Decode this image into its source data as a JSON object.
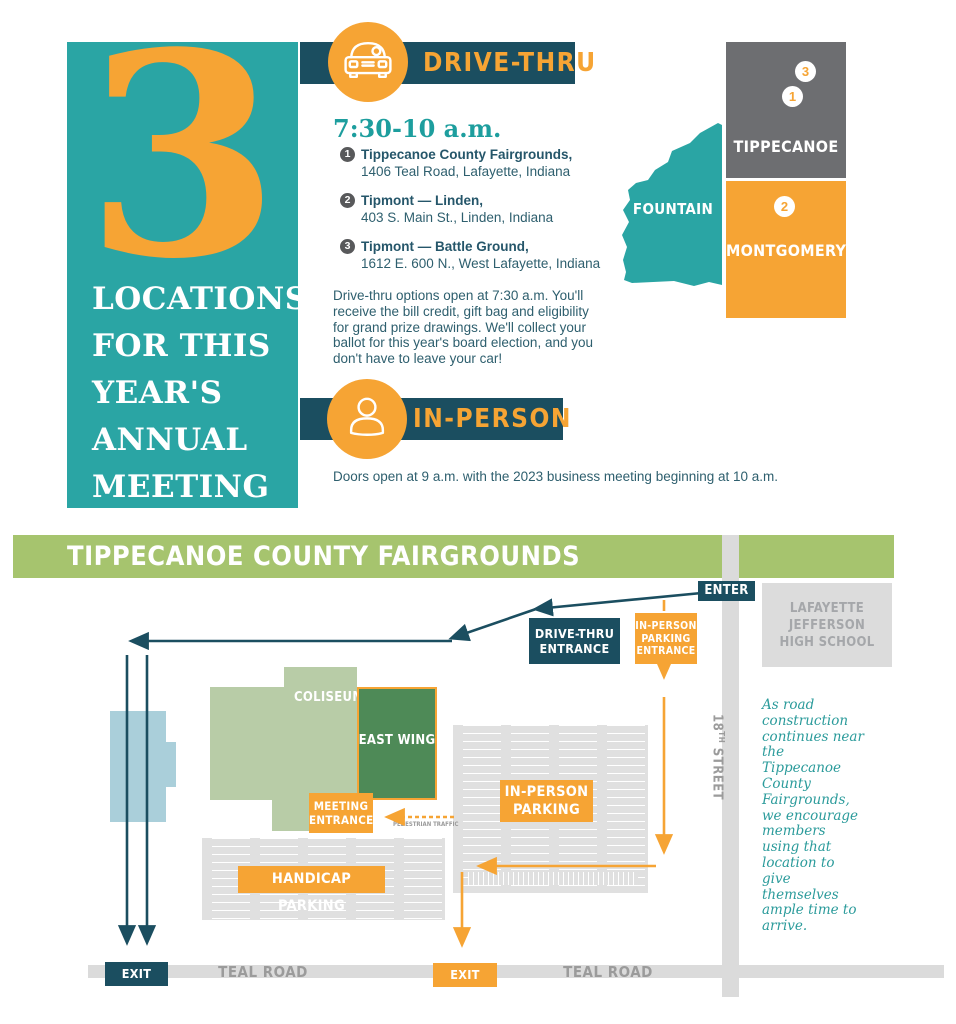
{
  "colors": {
    "teal": "#2aa5a4",
    "navy": "#1b4e60",
    "orange": "#f6a434",
    "green_bar": "#a6c46e",
    "sage_building": "#b8cca7",
    "dark_green_building": "#4e8a57",
    "light_blue_building": "#aacfda",
    "county_gray": "#6d6e71",
    "lot_gray": "#e0e0e0",
    "road_gray": "#dbdbdb",
    "body_text": "#2e5f6e"
  },
  "header": {
    "big_number": "3",
    "headline_lines": [
      "LOCATIONS",
      "FOR THIS",
      "YEAR'S",
      "ANNUAL",
      "MEETING"
    ]
  },
  "drive_thru": {
    "banner_label": "DRIVE-THRU",
    "time": "7:30-10 a.m.",
    "locations": [
      {
        "num": "1",
        "name": "Tippecanoe County Fairgrounds,",
        "address": "1406 Teal Road, Lafayette, Indiana"
      },
      {
        "num": "2",
        "name": "Tipmont — Linden,",
        "address": "403 S. Main St., Linden, Indiana"
      },
      {
        "num": "3",
        "name": "Tipmont — Battle Ground,",
        "address": "1612 E. 600 N., West Lafayette, Indiana"
      }
    ],
    "note": "Drive-thru options open at 7:30 a.m. You'll receive the bill credit, gift bag and eligibility for grand prize drawings. We'll collect your ballot for this year's board election, and you don't have to leave your car!"
  },
  "in_person": {
    "banner_label": "IN-PERSON",
    "note": "Doors open at 9 a.m. with the 2023 business meeting beginning at 10 a.m."
  },
  "county_map": {
    "fountain": "FOUNTAIN",
    "tippecanoe": "TIPPECANOE",
    "montgomery": "MONTGOMERY",
    "marker_3": "3",
    "marker_1": "1",
    "marker_2": "2"
  },
  "site_map": {
    "title": "TIPPECANOE COUNTY FAIRGROUNDS",
    "enter": "ENTER",
    "school_lines": [
      "LAFAYETTE",
      "JEFFERSON",
      "HIGH SCHOOL"
    ],
    "drive_thru_entrance": "DRIVE-THRU ENTRANCE",
    "in_person_parking_entrance": "IN-PERSON PARKING ENTRANCE",
    "coliseum": "COLISEUM",
    "east_wing": "EAST WING",
    "meeting_entrance": "MEETING ENTRANCE",
    "pedestrian_traffic": "PEDESTRIAN TRAFFIC",
    "in_person_parking": "IN-PERSON PARKING",
    "handicap_parking": "HANDICAP PARKING",
    "exit_only_west": "EXIT ONLY",
    "exit_only_east": "EXIT ONLY",
    "teal_road_west": "TEAL ROAD",
    "teal_road_east": "TEAL ROAD",
    "street_18": {
      "num": "18",
      "sup": "TH",
      "rest": " STREET"
    },
    "construction_note": "As road construction continues near the Tippecanoe County Fairgrounds, we encourage members using that location to give themselves ample time to arrive."
  }
}
